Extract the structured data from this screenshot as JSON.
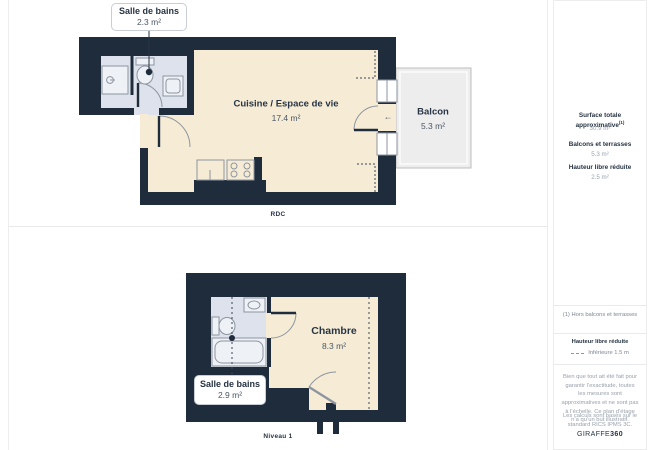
{
  "floorplans": {
    "rdc": {
      "level_label": "RDC",
      "callout": {
        "title": "Salle de bains",
        "area": "2.3 m²"
      },
      "rooms": {
        "living": {
          "name": "Cuisine / Espace de vie",
          "area": "17.4 m²"
        },
        "balcony": {
          "name": "Balcon",
          "area": "5.3 m²"
        }
      }
    },
    "niveau1": {
      "level_label": "Niveau 1",
      "callout": {
        "title": "Salle de bains",
        "area": "2.9 m²"
      },
      "rooms": {
        "bedroom": {
          "name": "Chambre",
          "area": "8.3 m²"
        }
      }
    }
  },
  "sidebar": {
    "total": {
      "label": "Surface totale approximative",
      "superscript": "(1)",
      "value": "30.9 m²"
    },
    "balconies": {
      "label": "Balcons et terrasses",
      "value": "5.3 m²"
    },
    "reduced_height": {
      "label": "Hauteur libre réduite",
      "value": "2.5 m²"
    },
    "footnote": "(1) Hors balcons et terrasses",
    "legend": {
      "label": "Hauteur libre réduite",
      "text": "Inférieure 1.5 m"
    },
    "disclaimer": "Bien que tout ait été fait pour garantir l’exactitude, toutes les mesures sont approximatives et ne sont pas à l’échelle. Ce plan d’étage n’a qu’un but illustratif.",
    "standard": "Les calculs sont basés sur le standard RICS IPMS 3C.",
    "logo": {
      "brand": "GIRAFFE",
      "suffix": "360"
    }
  },
  "icons": {
    "balcony_door_arrow": "←"
  },
  "colors": {
    "wall": "#1f2c3c",
    "room_cream": "#f6ecd6",
    "room_bath": "#dde2ec",
    "balcony": "#ededed",
    "fixture_stroke": "#8d95a0"
  }
}
